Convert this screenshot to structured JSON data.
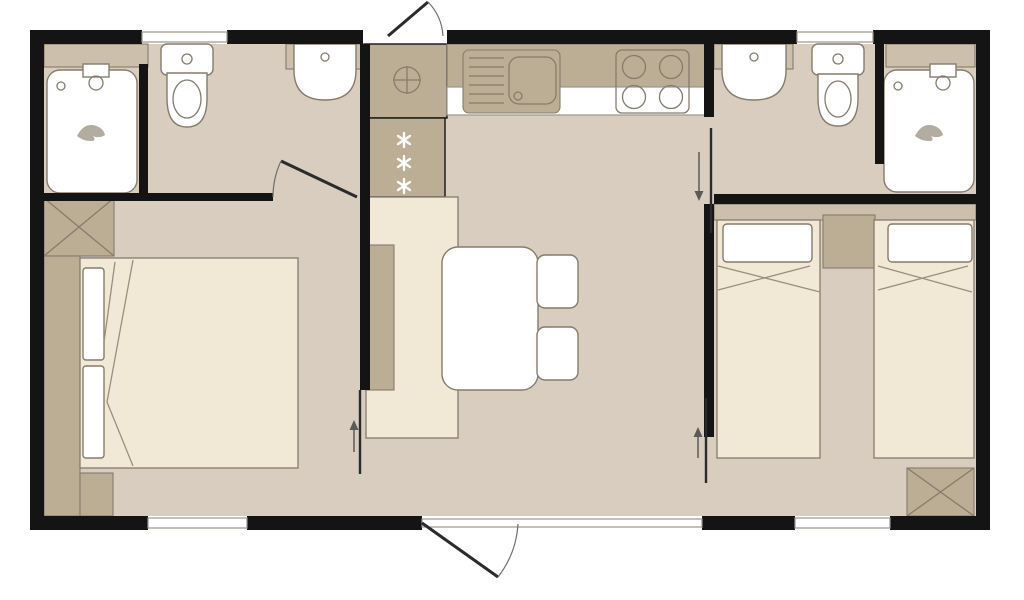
{
  "plan": {
    "kind": "mobile-home-floor-plan",
    "rooms": [
      {
        "name": "bathroom-left",
        "fixtures": [
          "shower-cubicle",
          "toilet",
          "wall-washbasin",
          "shelf-unit"
        ],
        "door": "hinged-door"
      },
      {
        "name": "bedroom-left",
        "fixtures": [
          "double-bed",
          "two-pillows",
          "headboard",
          "cross-wardrobe",
          "foot-bench"
        ],
        "door": "sliding-door"
      },
      {
        "name": "kitchen-living",
        "fixtures": [
          "water-heater-unit",
          "fridge-freezer",
          "sink-with-drainer",
          "hob-four-burners",
          "dining-bench",
          "dining-table",
          "chair",
          "chair"
        ],
        "doors": [
          "entrance-door-top",
          "entrance-door-bottom",
          "patio-glazing"
        ]
      },
      {
        "name": "bathroom-right",
        "fixtures": [
          "wall-washbasin",
          "toilet",
          "shower-cubicle",
          "shelf-unit"
        ],
        "door": "sliding-door"
      },
      {
        "name": "bedroom-right",
        "fixtures": [
          "single-bed",
          "single-bed",
          "two-pillows",
          "nightstand",
          "cross-wardrobe"
        ],
        "door": "sliding-door"
      }
    ],
    "window_count": 4,
    "entrance_door_count": 2,
    "icons": [
      "freezer-stars-icon",
      "valve-cross-circle-icon",
      "tap-icon",
      "drain-icon",
      "burner-icon",
      "direction-arrow-icon",
      "door-swing-arc-icon",
      "wardrobe-cross-icon",
      "shower-logo-icon"
    ]
  },
  "colors": {
    "wall": "#141414",
    "floor": "#d9cdbf",
    "cabinet": "#bcae95",
    "cabinetLight": "#ccc0ac",
    "bedding": "#f1e9d6",
    "fixture": "#ffffff",
    "outline": "#857c6c",
    "windowFrame": "#9b968c",
    "door": "#2b2b2b",
    "arcLine": "#6f6f6f",
    "arrowColor": "#5a5a5a",
    "foldLine": "#9a8f7b",
    "starColor": "#ffffff",
    "waveColor": "#b3aca0"
  }
}
